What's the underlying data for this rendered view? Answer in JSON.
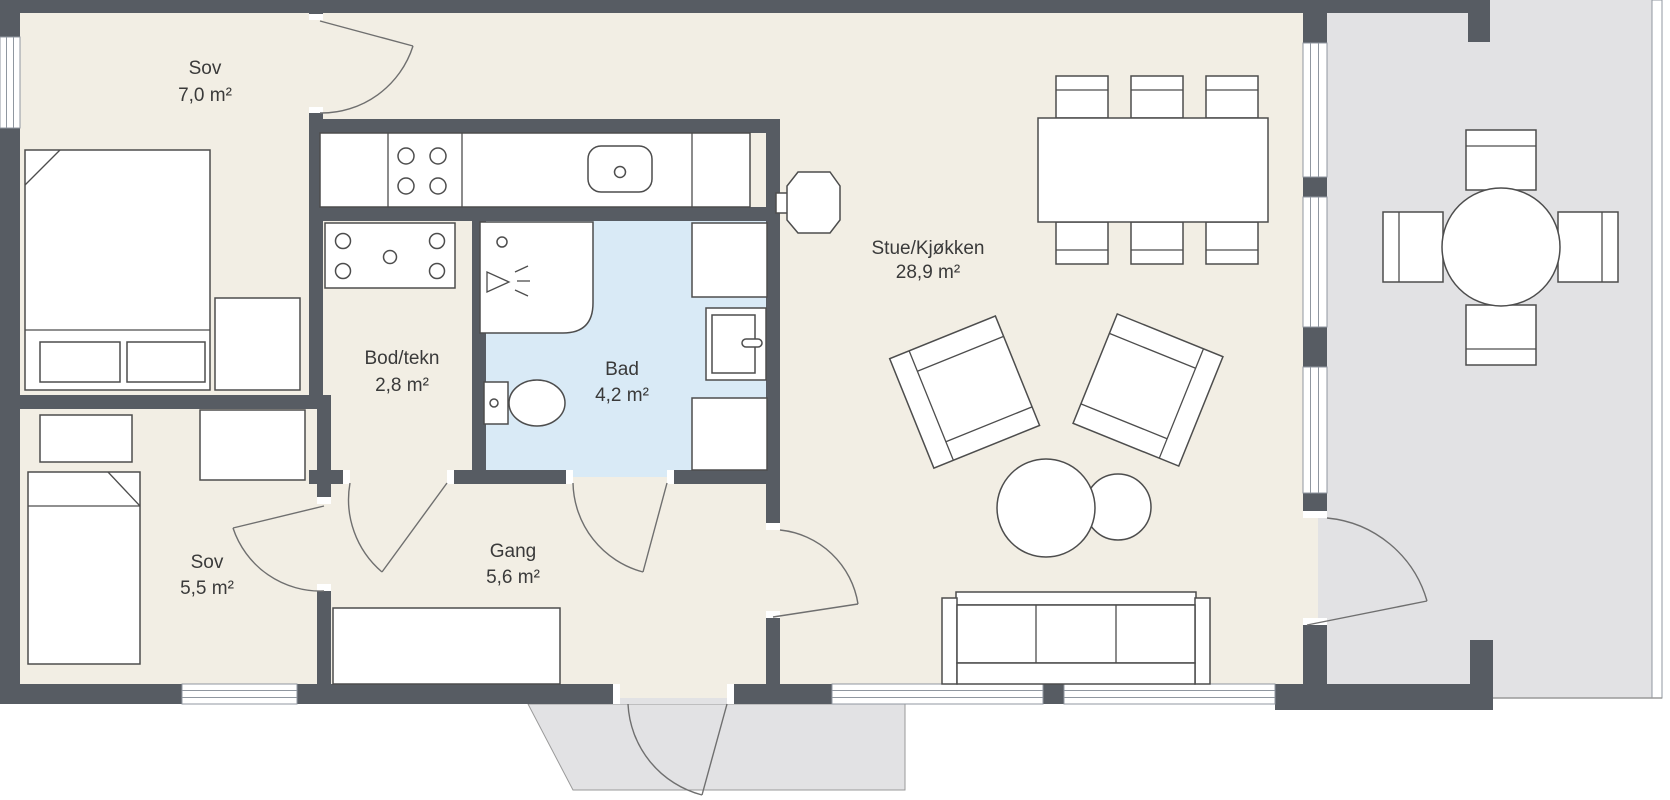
{
  "plan": {
    "rooms": [
      {
        "id": "sov-7",
        "name": "Sov",
        "area": "7,0 m²"
      },
      {
        "id": "bod-tekn",
        "name": "Bod/tekn",
        "area": "2,8 m²"
      },
      {
        "id": "bad",
        "name": "Bad",
        "area": "4,2 m²"
      },
      {
        "id": "gang",
        "name": "Gang",
        "area": "5,6 m²"
      },
      {
        "id": "sov-5",
        "name": "Sov",
        "area": "5,5 m²"
      },
      {
        "id": "stue-kjokken",
        "name": "Stue/Kjøkken",
        "area": "28,9 m²"
      }
    ],
    "colors": {
      "wall": "#575c63",
      "floor": "#f2eee4",
      "bathroom_floor": "#d9eaf6",
      "terrace": "#e2e2e4",
      "furniture_outline": "#4d4d4d",
      "label_text": "#3a3a3a"
    },
    "furniture_icons": [
      "double-bed",
      "pillow",
      "nightstand",
      "single-bed",
      "wardrobe",
      "hall-bench",
      "kitchen-counter",
      "cooktop",
      "kitchen-sink",
      "tech-unit",
      "shower",
      "toilet",
      "bathroom-cabinet",
      "washing-machine",
      "wood-stove",
      "dining-table",
      "dining-chair",
      "armchair",
      "coffee-table",
      "sofa",
      "terrace-table",
      "terrace-chair"
    ]
  }
}
